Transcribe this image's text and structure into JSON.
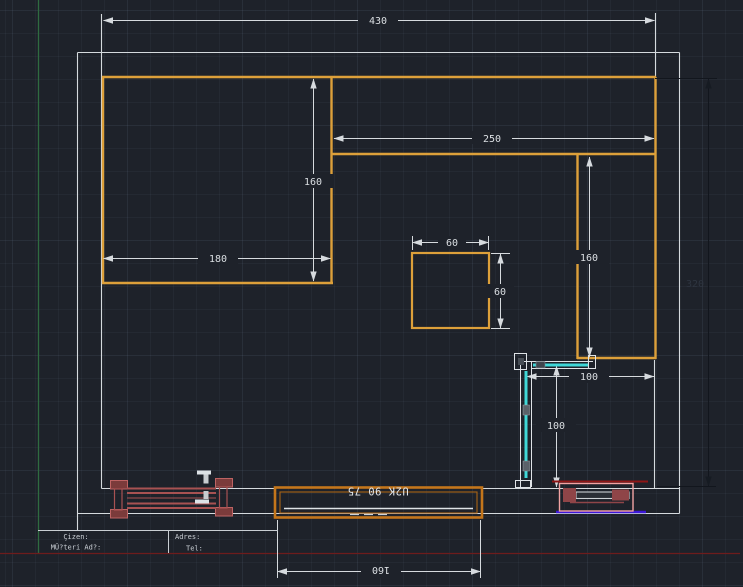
{
  "viewport": {
    "type": "cad-model-space",
    "plan": "kitchen floor plan"
  },
  "dims": {
    "total_width": "430",
    "right_run_width": "250",
    "left_counter_depth": "160",
    "left_counter_width": "180",
    "island_width": "60",
    "island_depth": "60",
    "right_counter_depth": "160",
    "room_depth": "320",
    "shower_width": "100",
    "shower_depth": "100",
    "door_width": "160"
  },
  "door": {
    "tag": "U2K 90 75"
  },
  "title_block": {
    "drawn_by": "Çizen:",
    "customer": "MÜ?teri Ad?:",
    "address": "Adres:",
    "phone": "Tel:"
  },
  "colors": {
    "background": "#1e222a",
    "wall_white": "#d5dade",
    "counter_orange": "#dda03a",
    "door_orange": "#c4761b",
    "glass_cyan": "#3fd7d7",
    "radiator_red": "#a85252",
    "radiator_pink": "#f2a2a2",
    "accent_dark_red": "#8e1515",
    "accent_blue": "#3c17d8",
    "axis_green": "#2f6b40",
    "axis_red": "#6e1c1c",
    "dim_dark": "#12161d"
  }
}
